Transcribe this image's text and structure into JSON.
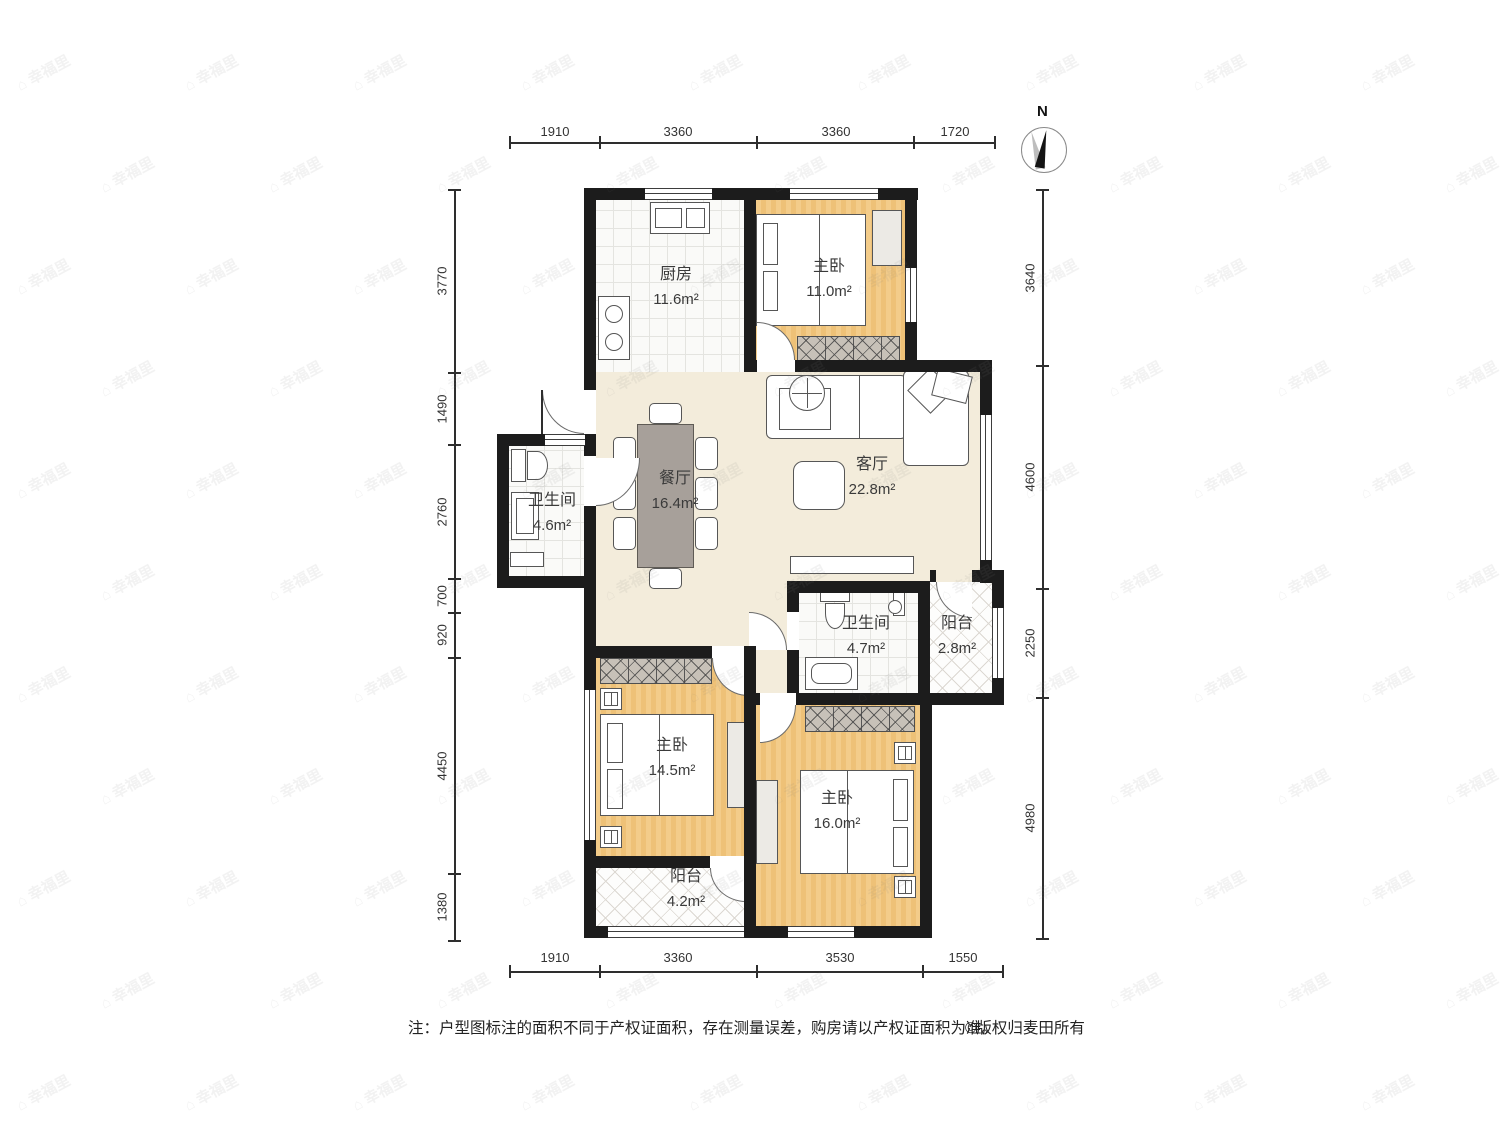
{
  "compass": {
    "label": "N"
  },
  "rooms": {
    "kitchen": {
      "name": "厨房",
      "area": "11.6m²"
    },
    "bedroom_top": {
      "name": "主卧",
      "area": "11.0m²"
    },
    "living": {
      "name": "客厅",
      "area": "22.8m²"
    },
    "dining": {
      "name": "餐厅",
      "area": "16.4m²"
    },
    "bath_main": {
      "name": "卫生间",
      "area": "4.6m²"
    },
    "bath_second": {
      "name": "卫生间",
      "area": "4.7m²"
    },
    "balcony_east": {
      "name": "阳台",
      "area": "2.8m²"
    },
    "bedroom_left": {
      "name": "主卧",
      "area": "14.5m²"
    },
    "bedroom_right": {
      "name": "主卧",
      "area": "16.0m²"
    },
    "balcony_south": {
      "name": "阳台",
      "area": "4.2m²"
    }
  },
  "dimensions": {
    "top": [
      "1910",
      "3360",
      "3360",
      "1720"
    ],
    "bottom": [
      "1910",
      "3360",
      "3530",
      "1550"
    ],
    "left": [
      "3770",
      "1490",
      "2760",
      "700",
      "920",
      "4450",
      "1380"
    ],
    "right": [
      "3640",
      "4600",
      "2250",
      "4980"
    ]
  },
  "footer": {
    "note": "注：户型图标注的面积不同于产权证面积，存在测量误差，购房请以产权证面积为准。",
    "copyright": "©版权归麦田所有"
  },
  "watermark": {
    "icon": "⌂",
    "text": "幸福里"
  },
  "colors": {
    "wall": "#1c1c1c",
    "bedroom_floor": "#f2c67d",
    "living_floor": "#f3ecdb",
    "tile_floor": "#fafaf8",
    "wardrobe": "#c7c1b8"
  }
}
